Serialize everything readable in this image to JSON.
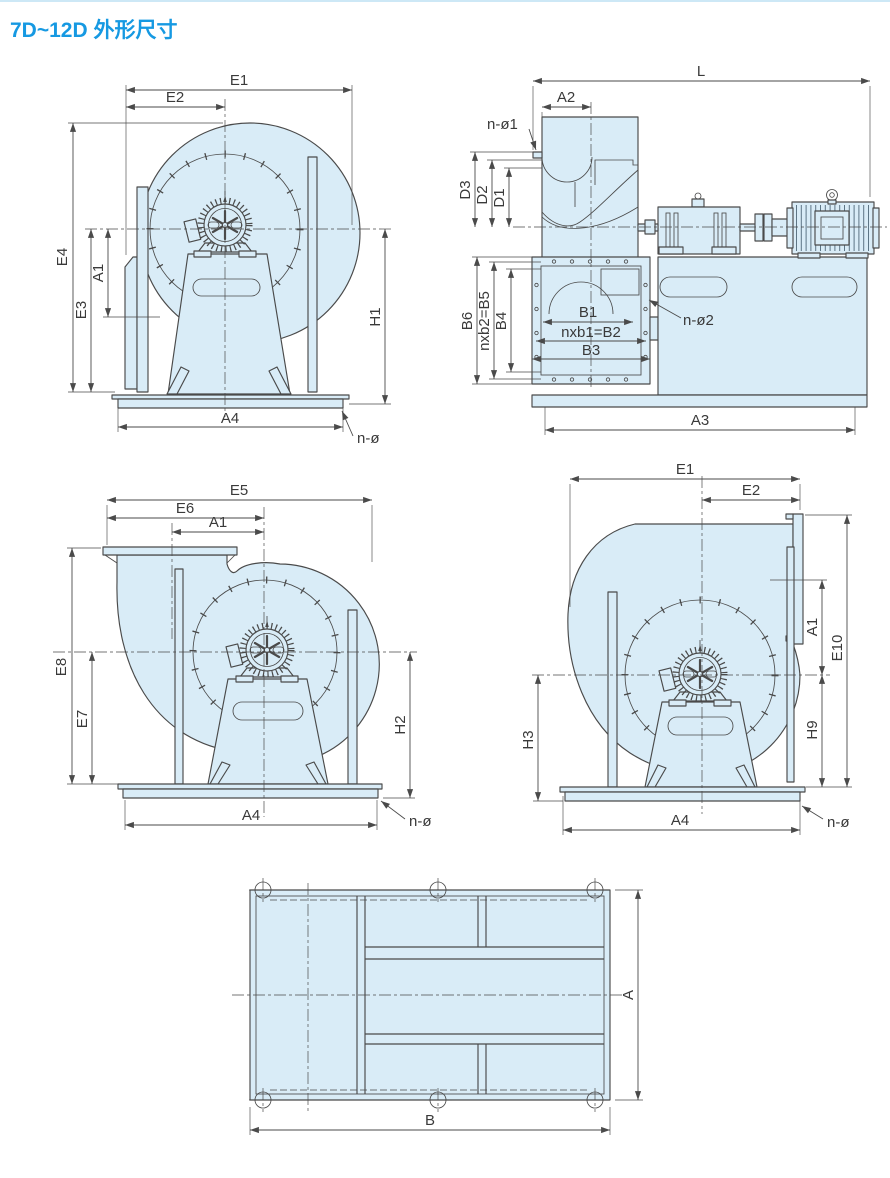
{
  "title": "7D~12D 外形尺寸",
  "colors": {
    "accent": "#1699e2",
    "fill": "#d9ecf7",
    "line": "#4a4a4a"
  },
  "views": {
    "v1": {
      "e1": "E1",
      "e2": "E2",
      "e4": "E4",
      "e3": "E3",
      "a1": "A1",
      "h1": "H1",
      "a4": "A4",
      "n_o": "n-ø"
    },
    "v2": {
      "l": "L",
      "a2": "A2",
      "n_o1": "n-ø1",
      "d3": "D3",
      "d2": "D2",
      "d1": "D1",
      "b6": "B6",
      "b5": "nxb2=B5",
      "b4": "B4",
      "b1": "B1",
      "b2": "nxb1=B2",
      "b3": "B3",
      "n_o2": "n-ø2",
      "a3": "A3"
    },
    "v3": {
      "e5": "E5",
      "e6": "E6",
      "a1": "A1",
      "e8": "E8",
      "e7": "E7",
      "h2": "H2",
      "a4": "A4",
      "n_o": "n-ø"
    },
    "v4": {
      "e1": "E1",
      "e2": "E2",
      "a1": "A1",
      "e10": "E10",
      "h9": "H9",
      "h3": "H3",
      "a4": "A4",
      "n_o": "n-ø"
    },
    "v5": {
      "a": "A",
      "b": "B"
    }
  }
}
